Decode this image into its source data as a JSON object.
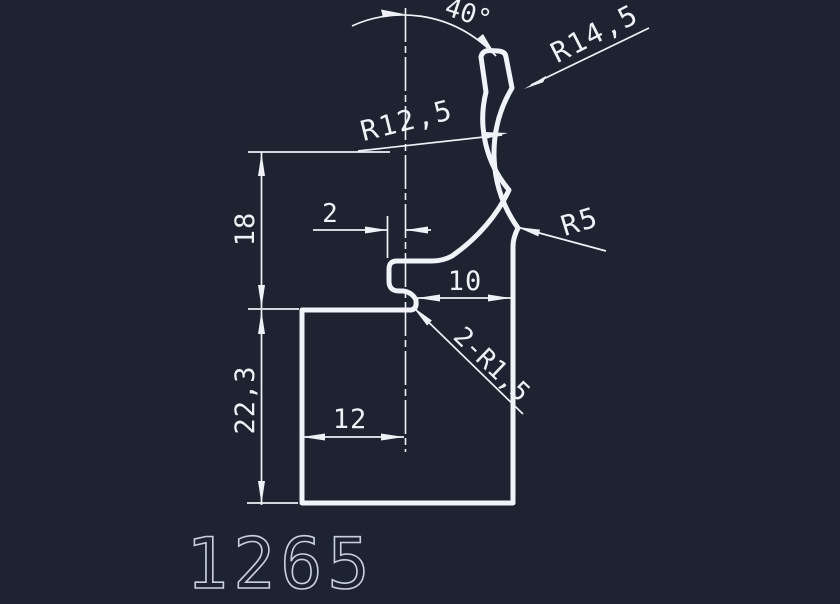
{
  "drawing": {
    "part_number": "1265",
    "background_color": "#1d2330",
    "line_color": "#f0f3f7",
    "dimensions": {
      "angle": "40°",
      "radius_outer": "R14,5",
      "radius_inner": "R12,5",
      "radius_corner": "R5",
      "wall_thickness": "2",
      "height_upper": "18",
      "opening_width": "10",
      "width_inner": "12",
      "height_lower": "22,3",
      "lip_fillets": "2-R1,5"
    }
  }
}
